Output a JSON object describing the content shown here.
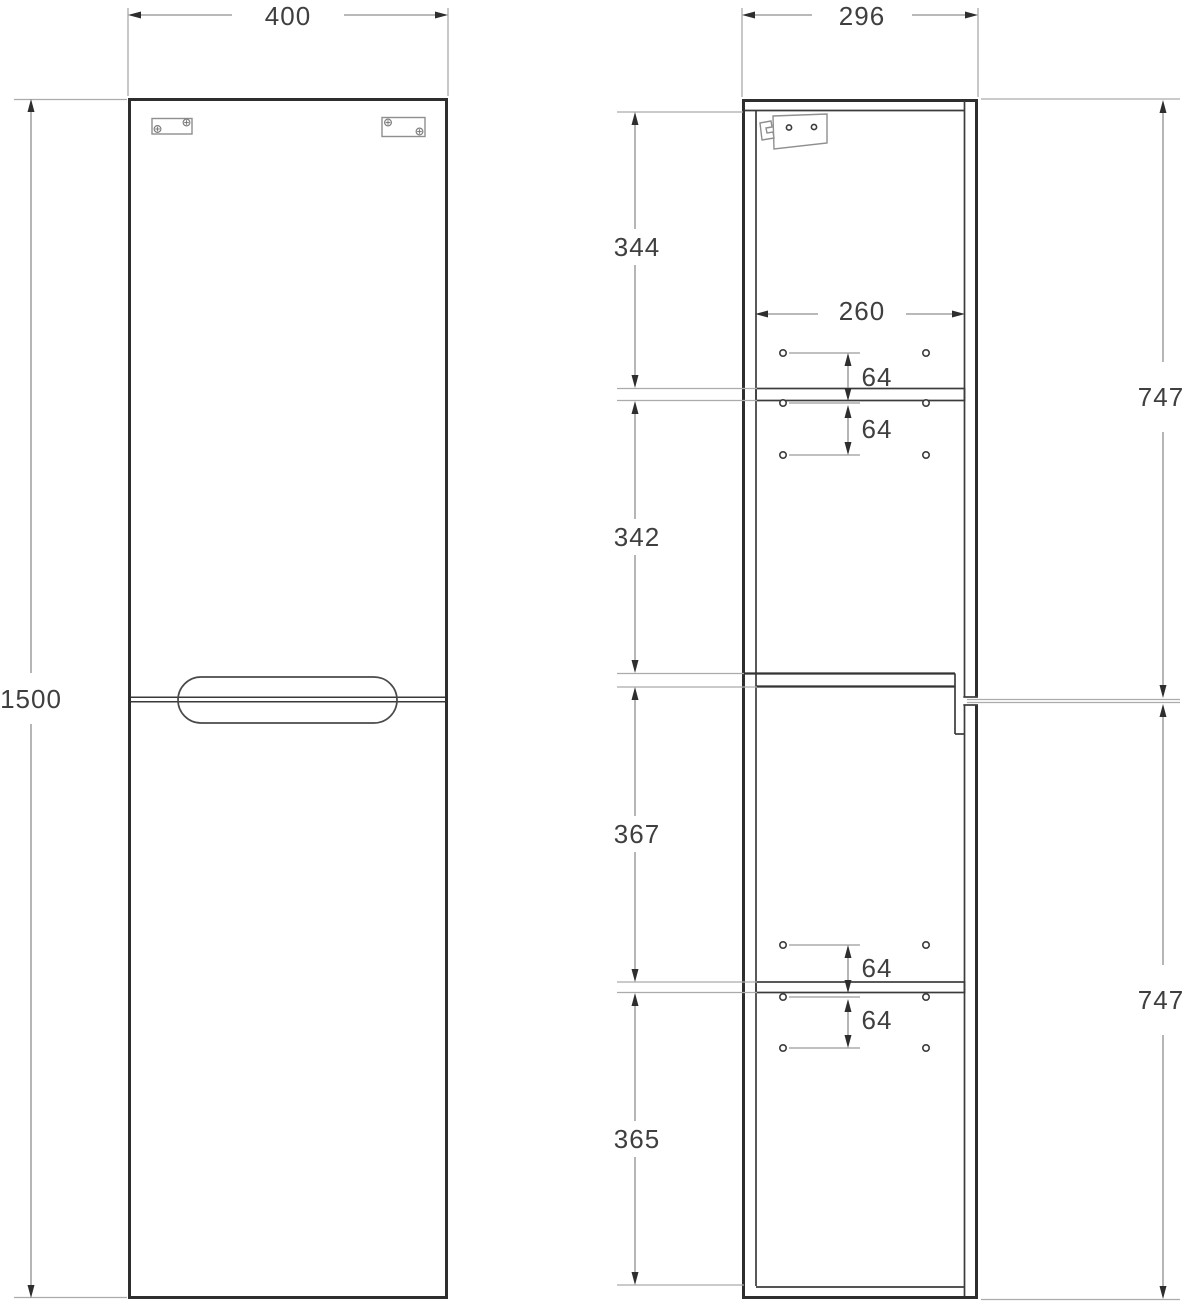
{
  "drawing": {
    "type": "cabinet technical drawing, two orthographic views",
    "units": "mm",
    "colors": {
      "background": "#ffffff",
      "outline": "#2e2e2e",
      "dimension_line": "#8f8f8f",
      "extension_line": "#ababab",
      "label_text": "#3f3f3f",
      "hardware": "#8f8f8f"
    },
    "front_view": {
      "overall_width": "400",
      "overall_height": "1500"
    },
    "side_view": {
      "overall_depth": "296",
      "interior_depth": "260",
      "sections": {
        "top": "344",
        "upper_middle": "342",
        "lower_middle": "367",
        "bottom": "365"
      },
      "shelf_hole_spacing": [
        "64",
        "64",
        "64",
        "64"
      ],
      "door_heights": [
        "747",
        "747"
      ]
    }
  }
}
